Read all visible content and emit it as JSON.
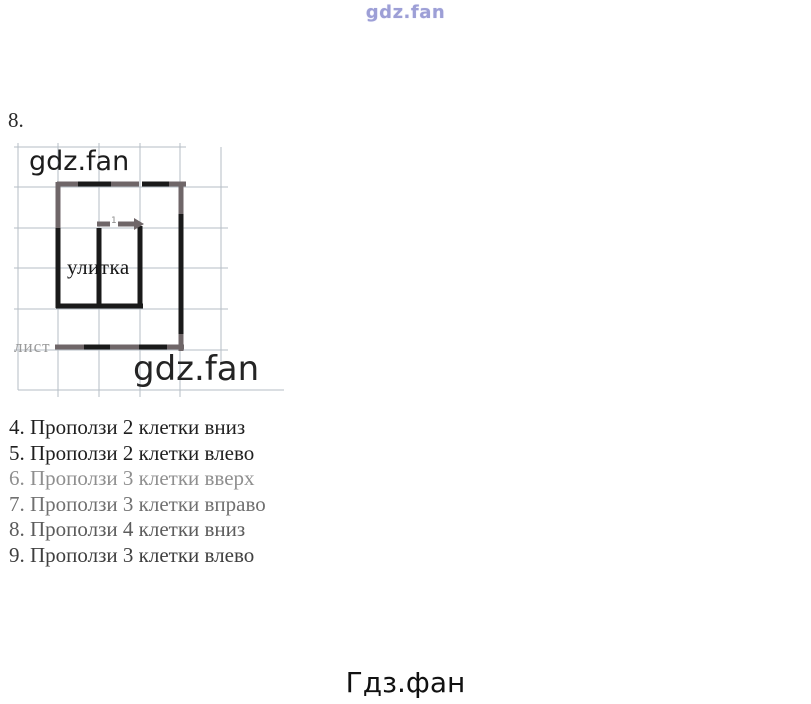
{
  "page": {
    "top_watermark": "gdz.fan",
    "problem_number": "8.",
    "footer": "Гдз.фан"
  },
  "diagram": {
    "watermark_upper": "gdz.fan",
    "watermark_lower": "gdz.fan",
    "snail_label": "улитка",
    "leaf_label": "лист",
    "step_mark": "1",
    "grid": {
      "color": "#b6bdc6",
      "h_lines": [
        [
          14,
          147,
          186
        ],
        [
          14,
          187,
          228
        ],
        [
          14,
          228,
          228
        ],
        [
          14,
          268,
          228
        ],
        [
          14,
          309,
          228
        ],
        [
          14,
          350,
          228
        ],
        [
          18,
          390,
          284
        ]
      ],
      "v_lines": [
        [
          18,
          143,
          390
        ],
        [
          58,
          143,
          397
        ],
        [
          99,
          143,
          397
        ],
        [
          140,
          143,
          397
        ],
        [
          180,
          143,
          397
        ],
        [
          221,
          147,
          362
        ]
      ]
    },
    "path": {
      "stroke_width": 5,
      "black": "#1a1a1a",
      "gray": "#6f6668",
      "segments": [
        [
          57,
          184,
          80,
          184,
          "g"
        ],
        [
          78,
          184,
          113,
          184,
          "b"
        ],
        [
          111,
          184,
          139,
          184,
          "g"
        ],
        [
          142,
          184,
          171,
          184,
          "b"
        ],
        [
          169,
          184,
          186,
          184,
          "g"
        ],
        [
          181,
          182,
          181,
          218,
          "g"
        ],
        [
          181,
          214,
          181,
          337,
          "b"
        ],
        [
          181,
          334,
          181,
          351,
          "g"
        ],
        [
          55,
          347,
          86,
          347,
          "g"
        ],
        [
          84,
          347,
          112,
          347,
          "b"
        ],
        [
          110,
          347,
          141,
          347,
          "g"
        ],
        [
          139,
          347,
          169,
          347,
          "b"
        ],
        [
          167,
          347,
          184,
          347,
          "g"
        ],
        [
          58,
          182,
          58,
          232,
          "g"
        ],
        [
          58,
          228,
          58,
          308,
          "b"
        ],
        [
          99,
          228,
          99,
          308,
          "b"
        ],
        [
          140,
          226,
          140,
          308,
          "b"
        ],
        [
          56,
          306,
          143,
          306,
          "b"
        ],
        [
          97,
          224,
          110,
          224,
          "g"
        ],
        [
          118,
          224,
          134,
          224,
          "g"
        ]
      ],
      "arrow_head": [
        134,
        218,
        134,
        230,
        144,
        224
      ],
      "arrow_color": "#6f6668"
    }
  },
  "instructions": {
    "items": [
      {
        "text": "4. Проползи 2 клетки вниз",
        "color": "#1f1f1f"
      },
      {
        "text": "5. Проползи 2 клетки влево",
        "color": "#1f1f1f"
      },
      {
        "text": "6. Проползи 3 клетки вверх",
        "color": "#8f8f8f"
      },
      {
        "text": "7. Проползи 3 клетки вправо",
        "color": "#707070"
      },
      {
        "text": "8. Проползи 4 клетки вниз",
        "color": "#5c5c5c"
      },
      {
        "text": "9. Проползи 3 клетки влево",
        "color": "#3f3f3f"
      }
    ]
  }
}
